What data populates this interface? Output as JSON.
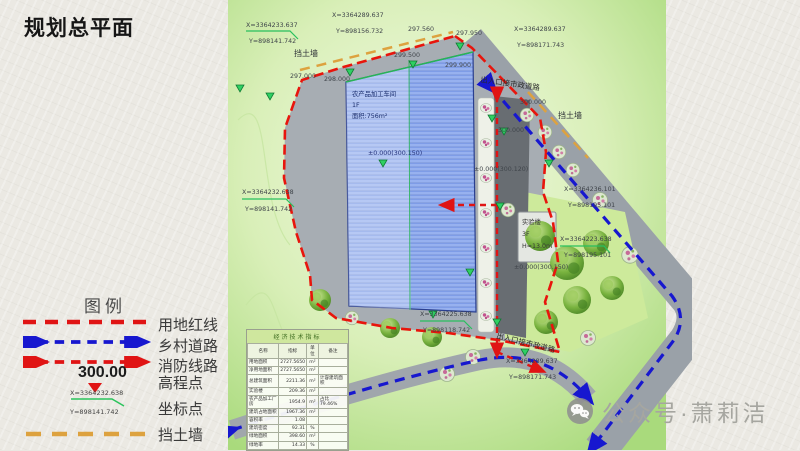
{
  "title": "规划总平面",
  "colors": {
    "land_red_line": "#e01414",
    "village_road": "#1717cf",
    "fire_route": "#e01414",
    "retaining_wall": "#dda23f",
    "site_green": "#aedc80",
    "building_blue": "#8fabec"
  },
  "legend": {
    "heading": "图例",
    "items": [
      {
        "name": "land-red-line",
        "label": "用地红线"
      },
      {
        "name": "village-road",
        "label": "乡村道路"
      },
      {
        "name": "fire-route",
        "label": "消防线路"
      },
      {
        "name": "elevation-point",
        "label": "高程点",
        "sample": "300.00"
      },
      {
        "name": "coordinate-point",
        "label": "坐标点",
        "sample_x": "X=3364232.638",
        "sample_y": "Y=898141.742"
      },
      {
        "name": "retaining-wall",
        "label": "挡土墙"
      }
    ]
  },
  "plan": {
    "labels": [
      {
        "text": "X=3364233.637"
      },
      {
        "text": "Y=898141.742"
      },
      {
        "text": "X=3364289.637"
      },
      {
        "text": "Y=898156.732"
      },
      {
        "text": "挡土墙"
      },
      {
        "text": "297.560"
      },
      {
        "text": "297.950"
      },
      {
        "text": "X=3364289.637"
      },
      {
        "text": "Y=898171.743"
      },
      {
        "text": "出入口接市政道路"
      },
      {
        "text": "挡土墙"
      },
      {
        "text": "297.000"
      },
      {
        "text": "298.000"
      },
      {
        "text": "299.500"
      },
      {
        "text": "299.900"
      },
      {
        "text": "300.000"
      },
      {
        "text": "300.000"
      },
      {
        "text": "±0.000(300.150)"
      },
      {
        "text": "±0.000(300.120)"
      },
      {
        "text": "X=3364236.101"
      },
      {
        "text": "Y=898195.101"
      },
      {
        "text": "X=3364223.638"
      },
      {
        "text": "Y=898195.101"
      },
      {
        "text": "X=3364232.638"
      },
      {
        "text": "Y=898141.742"
      },
      {
        "text": "X=3364225.638"
      },
      {
        "text": "Y=898118.742"
      },
      {
        "text": "出入口接市政道路"
      },
      {
        "text": "X=3364289.637"
      },
      {
        "text": "Y=898171.743"
      },
      {
        "text": "±0.000(300.150)"
      }
    ],
    "buildings": {
      "workshop": {
        "line1": "农产品加工车间",
        "line2": "1F",
        "line3": "面积:756m²"
      },
      "lab": {
        "line1": "实验楼",
        "line2": "3F",
        "line3": "H=13.0m"
      }
    },
    "table": {
      "title": "经济技术指标",
      "headers": [
        "名称",
        "指标",
        "单位",
        "备注"
      ],
      "rows": [
        [
          "用地面积",
          "2727.5650",
          "m²",
          ""
        ],
        [
          "净用地面积",
          "2727.5650",
          "m²",
          ""
        ],
        [
          "总建筑面积",
          "2211.36",
          "m²",
          "计容建筑面积"
        ],
        [
          "实验楼",
          "209.36",
          "m²",
          ""
        ],
        [
          "农产品加工厂房",
          "1954.9",
          "m²",
          "占比79.46%"
        ],
        [
          "建筑占地面积",
          "1967.36",
          "m²",
          ""
        ],
        [
          "容积率",
          "1.08",
          "",
          ""
        ],
        [
          "建筑密度",
          "92.31",
          "%",
          ""
        ],
        [
          "绿地面积",
          "398.60",
          "m²",
          ""
        ],
        [
          "绿地率",
          "14.33",
          "%",
          ""
        ]
      ]
    }
  },
  "watermark": {
    "icon": "wechat-icon",
    "text": "公众号·萧莉洁"
  }
}
